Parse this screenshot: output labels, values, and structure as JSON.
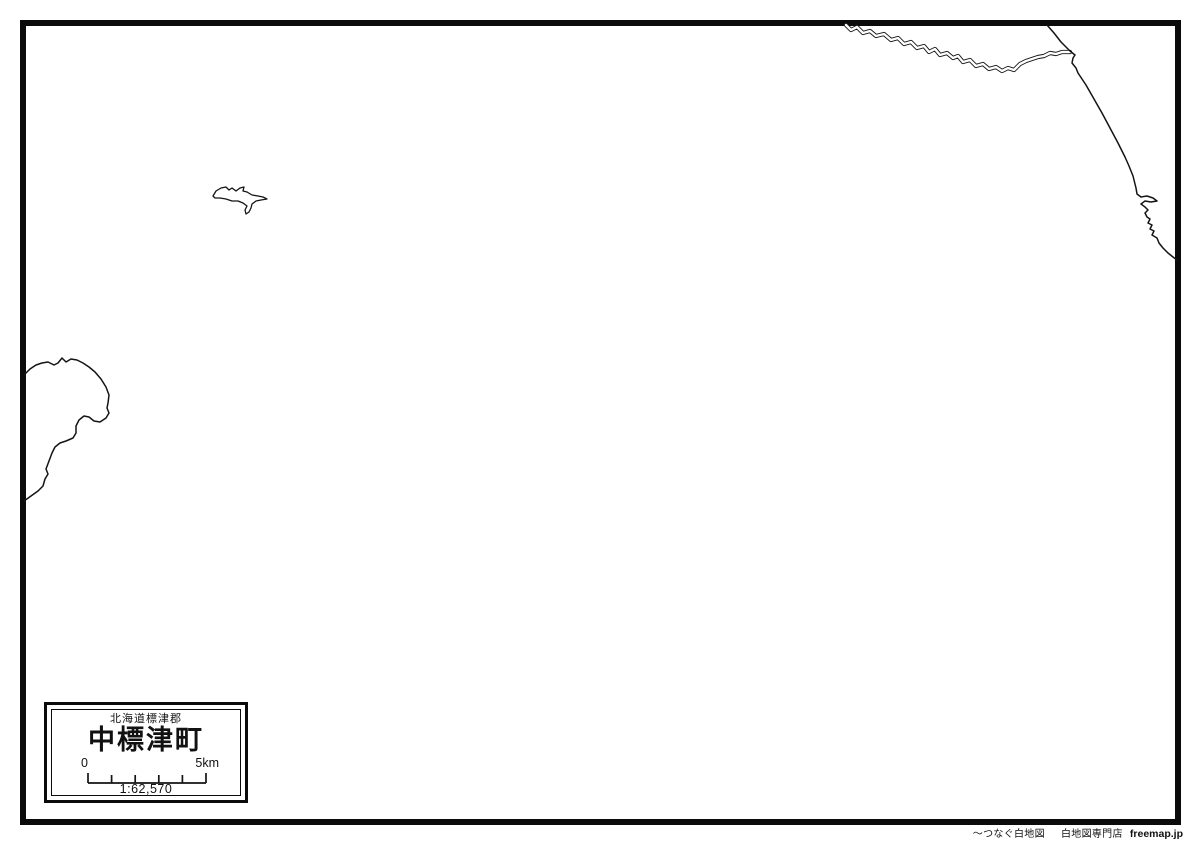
{
  "title_box": {
    "district": "北海道標津郡",
    "town": "中標津町",
    "scale_zero": "0",
    "scale_max": "5km",
    "scale_ratio": "1:62,570"
  },
  "footer": {
    "tagline": "〜つなぐ白地図",
    "shop": "白地図専門店",
    "brand": "freemap.jp"
  },
  "colors": {
    "background": "#ffffff",
    "line": "#141414",
    "border": "#0b0b0b"
  },
  "features": {
    "river": "winding-river-double-line",
    "boundary": "municipal-boundary-line",
    "coast_right": "right-edge-coastline-with-small-peninsula",
    "lake": "small-branched-lake-outline",
    "coast_left": "left-edge-coastline-bulge"
  }
}
